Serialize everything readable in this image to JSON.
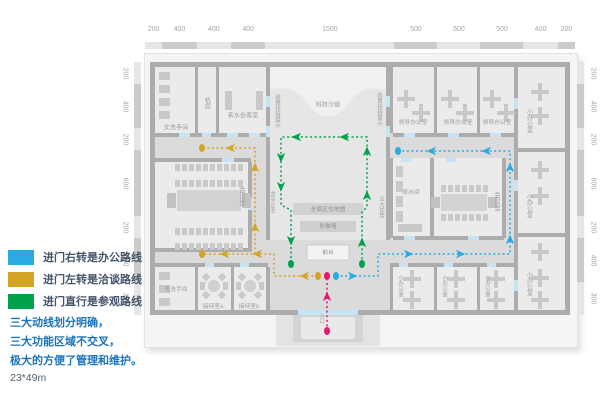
{
  "legend": {
    "items": [
      {
        "key": "office-route",
        "color": "#29ABE2",
        "label": "进门右转是办公路线"
      },
      {
        "key": "talk-route",
        "color": "#D4A427",
        "label": "进门左转是洽谈路线"
      },
      {
        "key": "visit-route",
        "color": "#00A14B",
        "label": "进门直行是参观路线"
      }
    ]
  },
  "notes": {
    "lines": [
      "三大动线划分明确，",
      "三大功能区域不交叉，",
      "极大的方便了管理和维护。"
    ],
    "area_size": "23*49m"
  },
  "rulers": {
    "top_values": [
      "200",
      "400",
      "400",
      "400",
      "1500",
      "500",
      "500",
      "500",
      "400",
      "200"
    ],
    "left_values": [
      "200",
      "400",
      "200",
      "600",
      "200",
      "400",
      "300"
    ],
    "right_values": [
      "200",
      "400",
      "200",
      "600",
      "200",
      "400",
      "300"
    ]
  },
  "colors": {
    "wall": "#ACACAC",
    "corridor": "#DBDBDB",
    "room": "#EBEBEB",
    "hall": "#E6E6E6",
    "hallTop": "#F0F0F0",
    "fixture": "#C9C9C9",
    "door": "#C7E3F4",
    "rulerA": "#E6E6E6",
    "rulerB": "#CBCBCB",
    "labelGray": "#9C9C9C",
    "entry": "#E5186E",
    "blue": "#29ABE2",
    "yellow": "#D4A427",
    "green": "#00A14B"
  },
  "plan": {
    "base": {
      "x": 155,
      "y": 67,
      "w": 410,
      "h": 243
    },
    "hall": {
      "x": 270,
      "y": 67,
      "w": 116,
      "h": 173
    },
    "hall_curve": "M270,67 H386 V90 C368,85 356,92 348,104 C338,120 318,120 308,104 C300,92 288,85 270,90 Z",
    "rooms": [
      [
        155,
        67,
        40,
        66
      ],
      [
        198,
        67,
        18,
        66
      ],
      [
        219,
        67,
        47,
        66
      ],
      [
        393,
        67,
        41,
        66
      ],
      [
        437,
        67,
        40,
        66
      ],
      [
        480,
        67,
        34,
        66
      ],
      [
        518,
        67,
        47,
        81
      ],
      [
        518,
        152,
        47,
        81
      ],
      [
        518,
        237,
        47,
        73
      ],
      [
        393,
        158,
        37,
        78
      ],
      [
        434,
        158,
        68,
        78
      ],
      [
        155,
        162,
        93,
        86
      ],
      [
        155,
        267,
        40,
        43
      ],
      [
        198,
        267,
        33,
        43
      ],
      [
        234,
        267,
        32,
        43
      ],
      [
        393,
        267,
        41,
        43
      ],
      [
        437,
        267,
        40,
        43
      ],
      [
        480,
        267,
        34,
        43
      ]
    ],
    "walls": [
      [
        150,
        62,
        420,
        5
      ],
      [
        150,
        310,
        148,
        5
      ],
      [
        358,
        310,
        212,
        5
      ],
      [
        150,
        62,
        5,
        253
      ],
      [
        565,
        62,
        5,
        253
      ],
      [
        195,
        67,
        3,
        66
      ],
      [
        216,
        67,
        3,
        66
      ],
      [
        266,
        67,
        4,
        173
      ],
      [
        386,
        67,
        4,
        173
      ],
      [
        155,
        133,
        111,
        4
      ],
      [
        155,
        158,
        96,
        4
      ],
      [
        248,
        162,
        4,
        86
      ],
      [
        155,
        248,
        97,
        4
      ],
      [
        155,
        263,
        113,
        4
      ],
      [
        195,
        267,
        3,
        43
      ],
      [
        231,
        267,
        3,
        43
      ],
      [
        266,
        267,
        4,
        43
      ],
      [
        390,
        67,
        3,
        66
      ],
      [
        434,
        67,
        3,
        66
      ],
      [
        477,
        67,
        3,
        66
      ],
      [
        393,
        133,
        124,
        4
      ],
      [
        390,
        158,
        3,
        80
      ],
      [
        430,
        158,
        4,
        80
      ],
      [
        502,
        158,
        4,
        80
      ],
      [
        393,
        236,
        111,
        4
      ],
      [
        390,
        263,
        3,
        47
      ],
      [
        393,
        263,
        121,
        4
      ],
      [
        434,
        267,
        3,
        43
      ],
      [
        477,
        267,
        3,
        43
      ],
      [
        514,
        67,
        4,
        243
      ],
      [
        518,
        148,
        47,
        4
      ],
      [
        518,
        233,
        47,
        4
      ]
    ],
    "doors": [
      [
        179,
        133,
        11,
        4
      ],
      [
        202,
        133,
        9,
        4
      ],
      [
        227,
        133,
        11,
        4
      ],
      [
        249,
        133,
        11,
        4
      ],
      [
        266,
        96,
        4,
        11
      ],
      [
        266,
        126,
        4,
        11
      ],
      [
        386,
        96,
        4,
        11
      ],
      [
        386,
        126,
        4,
        11
      ],
      [
        404,
        133,
        11,
        4
      ],
      [
        448,
        133,
        11,
        4
      ],
      [
        490,
        133,
        11,
        4
      ],
      [
        514,
        98,
        4,
        11
      ],
      [
        514,
        180,
        4,
        11
      ],
      [
        514,
        280,
        4,
        11
      ],
      [
        401,
        158,
        11,
        4
      ],
      [
        446,
        158,
        11,
        4
      ],
      [
        222,
        158,
        12,
        4
      ],
      [
        248,
        198,
        4,
        12
      ],
      [
        404,
        236,
        11,
        4
      ],
      [
        468,
        236,
        11,
        4
      ],
      [
        205,
        263,
        9,
        4
      ],
      [
        240,
        263,
        9,
        4
      ],
      [
        399,
        263,
        9,
        4
      ],
      [
        444,
        263,
        9,
        4
      ],
      [
        487,
        263,
        9,
        4
      ],
      [
        298,
        310,
        60,
        5
      ]
    ],
    "bands": [
      {
        "x": 293,
        "y": 203,
        "w": 70,
        "h": 12,
        "f": "#D2D2D2"
      },
      {
        "x": 300,
        "y": 221,
        "w": 56,
        "h": 11,
        "f": "#CFCFCF"
      },
      {
        "x": 307,
        "y": 245,
        "w": 42,
        "h": 15,
        "f": "#F3F3F3",
        "s": "#C4C4C4"
      }
    ],
    "entry_steps": [
      {
        "x": 276,
        "y": 315,
        "w": 104,
        "h": 31,
        "f": "#E3E3E3"
      },
      {
        "x": 293,
        "y": 315,
        "w": 70,
        "h": 27,
        "f": "#D3D3D3"
      },
      {
        "x": 301,
        "y": 317,
        "w": 54,
        "h": 22,
        "f": "#E9E9E9"
      }
    ],
    "fixtures": [
      {
        "t": "cc",
        "x": 159,
        "y": 72,
        "n": 4,
        "dy": 13,
        "w": 11,
        "h": 8
      },
      {
        "t": "cc",
        "x": 159,
        "y": 272,
        "n": 3,
        "dy": 13,
        "w": 11,
        "h": 8
      },
      {
        "t": "r",
        "x": 225,
        "y": 91,
        "w": 7,
        "h": 19
      },
      {
        "t": "r",
        "x": 256,
        "y": 91,
        "w": 7,
        "h": 19
      },
      {
        "t": "cr",
        "x": 175,
        "y": 164,
        "n": 10,
        "dx": 7,
        "w": 5,
        "h": 7
      },
      {
        "t": "cr",
        "x": 175,
        "y": 180,
        "n": 10,
        "dx": 7,
        "w": 5,
        "h": 7
      },
      {
        "t": "tb",
        "x": 177,
        "y": 190,
        "w": 64,
        "h": 21
      },
      {
        "t": "cr",
        "x": 175,
        "y": 228,
        "n": 10,
        "dx": 7,
        "w": 5,
        "h": 7
      },
      {
        "t": "cr",
        "x": 175,
        "y": 243,
        "n": 10,
        "dx": 7,
        "w": 5,
        "h": 7
      },
      {
        "t": "cr",
        "x": 441,
        "y": 185,
        "n": 7,
        "dx": 7,
        "w": 5,
        "h": 7
      },
      {
        "t": "tb",
        "x": 441,
        "y": 194,
        "w": 46,
        "h": 17
      },
      {
        "t": "cr",
        "x": 441,
        "y": 214,
        "n": 7,
        "dx": 7,
        "w": 5,
        "h": 7
      },
      {
        "t": "cc",
        "x": 396,
        "y": 166,
        "n": 4,
        "dy": 15,
        "w": 7,
        "h": 11
      },
      {
        "t": "r",
        "x": 398,
        "y": 224,
        "w": 24,
        "h": 8
      },
      {
        "t": "rt",
        "cx": 214,
        "cy": 286
      },
      {
        "t": "rt",
        "cx": 250,
        "cy": 286
      },
      {
        "t": "x",
        "cx": 406,
        "cy": 99
      },
      {
        "t": "x",
        "cx": 421,
        "cy": 113
      },
      {
        "t": "x",
        "cx": 450,
        "cy": 99
      },
      {
        "t": "x",
        "cx": 465,
        "cy": 113
      },
      {
        "t": "x",
        "cx": 492,
        "cy": 99
      },
      {
        "t": "x",
        "cx": 506,
        "cy": 113
      },
      {
        "t": "x",
        "cx": 412,
        "cy": 279
      },
      {
        "t": "x",
        "cx": 412,
        "cy": 300
      },
      {
        "t": "x",
        "cx": 456,
        "cy": 279
      },
      {
        "t": "x",
        "cx": 456,
        "cy": 300
      },
      {
        "t": "x",
        "cx": 496,
        "cy": 279
      },
      {
        "t": "x",
        "cx": 496,
        "cy": 300
      },
      {
        "t": "x",
        "cx": 540,
        "cy": 92
      },
      {
        "t": "x",
        "cx": 540,
        "cy": 116
      },
      {
        "t": "x",
        "cx": 540,
        "cy": 170
      },
      {
        "t": "x",
        "cx": 540,
        "cy": 196
      },
      {
        "t": "x",
        "cx": 540,
        "cy": 252
      },
      {
        "t": "x",
        "cx": 540,
        "cy": 278
      },
      {
        "t": "x",
        "cx": 540,
        "cy": 300
      }
    ],
    "labels": [
      {
        "t": "女洗手间",
        "x": 176,
        "y": 128
      },
      {
        "t": "机房",
        "x": 207,
        "y": 103,
        "v": 1
      },
      {
        "t": "茶水会客室",
        "x": 243,
        "y": 116
      },
      {
        "t": "科技沙盘",
        "x": 328,
        "y": 105
      },
      {
        "t": "政策扶持展示",
        "x": 277,
        "y": 111,
        "v": 1,
        "s": 5.5
      },
      {
        "t": "政策扶持展示",
        "x": 379,
        "y": 109,
        "v": 1,
        "s": 5.5
      },
      {
        "t": "龙头企业",
        "x": 272,
        "y": 202,
        "v": 1,
        "s": 5.5
      },
      {
        "t": "五大优势",
        "x": 381,
        "y": 207,
        "v": 1,
        "s": 5.5
      },
      {
        "t": "领导办公室",
        "x": 413,
        "y": 123,
        "s": 5.8
      },
      {
        "t": "领导办公室",
        "x": 458,
        "y": 123,
        "s": 5.8
      },
      {
        "t": "领导办公室",
        "x": 497,
        "y": 123,
        "s": 5.8
      },
      {
        "t": "小办公室",
        "x": 529,
        "y": 121,
        "v": 1
      },
      {
        "t": "小办公室",
        "x": 529,
        "y": 206,
        "v": 1
      },
      {
        "t": "小办公室",
        "x": 529,
        "y": 284,
        "v": 1
      },
      {
        "t": "茶水间",
        "x": 411,
        "y": 193,
        "s": 5.8
      },
      {
        "t": "会议室",
        "x": 241,
        "y": 196,
        "v": 1,
        "s": 6.5
      },
      {
        "t": "会议室",
        "x": 496,
        "y": 201,
        "v": 1,
        "s": 6.5
      },
      {
        "t": "全景区位地图",
        "x": 328,
        "y": 210,
        "s": 5.8,
        "c": "#8F8F8F"
      },
      {
        "t": "形象墙",
        "x": 328,
        "y": 227,
        "s": 5.8,
        "c": "#8F8F8F"
      },
      {
        "t": "前台",
        "x": 328,
        "y": 253,
        "s": 5.8,
        "c": "#8F8F8F"
      },
      {
        "t": "男洗手间",
        "x": 176,
        "y": 290,
        "s": 5.8
      },
      {
        "t": "接待室a",
        "x": 213,
        "y": 307,
        "s": 5.8
      },
      {
        "t": "接待室b",
        "x": 249,
        "y": 307,
        "s": 5.8
      },
      {
        "t": "小办公室",
        "x": 400,
        "y": 286,
        "v": 1,
        "s": 5.5
      },
      {
        "t": "小办公室",
        "x": 444,
        "y": 286,
        "v": 1,
        "s": 5.5
      },
      {
        "t": "小办公室",
        "x": 487,
        "y": 286,
        "v": 1,
        "s": 5.5
      },
      {
        "t": "入口",
        "x": 321,
        "y": 318,
        "v": 1,
        "s": 5.5
      }
    ],
    "routes": [
      {
        "name": "visit-route",
        "color": "#00A14B",
        "polylines": [
          [
            [
              362,
              264
            ],
            [
              362,
              212
            ],
            [
              367,
              207
            ],
            [
              367,
              137
            ],
            [
              281,
              137
            ],
            [
              281,
              205
            ],
            [
              291,
              210
            ],
            [
              291,
              264
            ]
          ]
        ],
        "arrows": [
          [
            362,
            243,
            "up"
          ],
          [
            367,
            196,
            "up"
          ],
          [
            367,
            152,
            "up"
          ],
          [
            345,
            137,
            "left"
          ],
          [
            297,
            137,
            "left"
          ],
          [
            281,
            157,
            "down"
          ],
          [
            281,
            186,
            "down"
          ],
          [
            291,
            240,
            "down"
          ]
        ],
        "dots": [
          [
            362,
            264
          ],
          [
            291,
            264
          ]
        ]
      },
      {
        "name": "talk-route",
        "color": "#D4A427",
        "polylines": [
          [
            [
              318,
              276
            ],
            [
              274,
              276
            ],
            [
              274,
              254
            ],
            [
              202,
              254
            ]
          ],
          [
            [
              255,
              254
            ],
            [
              255,
              148
            ],
            [
              202,
              148
            ]
          ]
        ],
        "arrows": [
          [
            305,
            276,
            "left"
          ],
          [
            258,
            254,
            "left"
          ],
          [
            225,
            254,
            "left"
          ],
          [
            255,
            228,
            "up"
          ],
          [
            255,
            168,
            "up"
          ],
          [
            231,
            148,
            "left"
          ]
        ],
        "dots": [
          [
            318,
            276
          ],
          [
            202,
            254
          ],
          [
            202,
            148
          ]
        ]
      },
      {
        "name": "office-route",
        "color": "#29ABE2",
        "polylines": [
          [
            [
              336,
              276
            ],
            [
              378,
              276
            ],
            [
              378,
              254
            ],
            [
              510,
              254
            ],
            [
              510,
              151
            ],
            [
              398,
              151
            ]
          ]
        ],
        "arrows": [
          [
            352,
            276,
            "right"
          ],
          [
            408,
            254,
            "right"
          ],
          [
            460,
            254,
            "right"
          ],
          [
            510,
            240,
            "up"
          ],
          [
            510,
            168,
            "up"
          ],
          [
            487,
            151,
            "left"
          ],
          [
            432,
            151,
            "left"
          ]
        ],
        "dots": [
          [
            336,
            276
          ],
          [
            398,
            151
          ]
        ]
      },
      {
        "name": "entry-route",
        "color": "#E5186E",
        "polylines": [
          [
            [
              327,
              331
            ],
            [
              327,
              277
            ]
          ]
        ],
        "arrows": [
          [
            327,
            297,
            "up"
          ]
        ],
        "dots": [
          [
            327,
            331
          ],
          [
            327,
            276
          ]
        ]
      }
    ]
  }
}
